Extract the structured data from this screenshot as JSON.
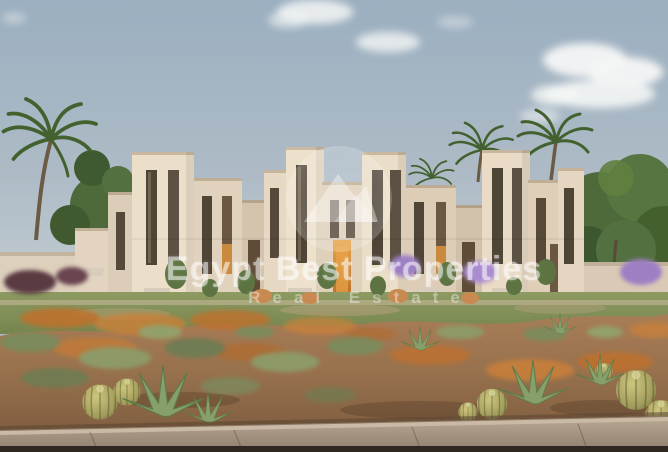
{
  "watermark": {
    "title": "Egypt Best Properties",
    "subtitle": "Real Estate",
    "logo": "mountain-peak-circle-icon"
  },
  "scene": {
    "subject": "Rendering of a row of modern beige desert townhouses with palm trees, lawn, xeriscape gravel garden with barrel cacti and agaves, and a front sidewalk",
    "colors": {
      "sky_top": "#9bafc0",
      "sky_horizon": "#c7cfd4",
      "cloud_white": "#f4f6f5",
      "building_light": "#ecdfca",
      "building_shade": "#d5c4af",
      "window_dark": "#4f4537",
      "door_glow": "#d98f35",
      "lawn_green": "#87955c",
      "tree_green": "#4e6a3a",
      "desert_soil": "#9c7350",
      "orange_grass": "#c0702c",
      "sage_shrub": "#7d8a5c",
      "cactus_body": "#b0aa66",
      "flower_purple": "#9d7fc4",
      "sidewalk": "#a99a87",
      "curb_shadow": "#2e2720"
    }
  }
}
